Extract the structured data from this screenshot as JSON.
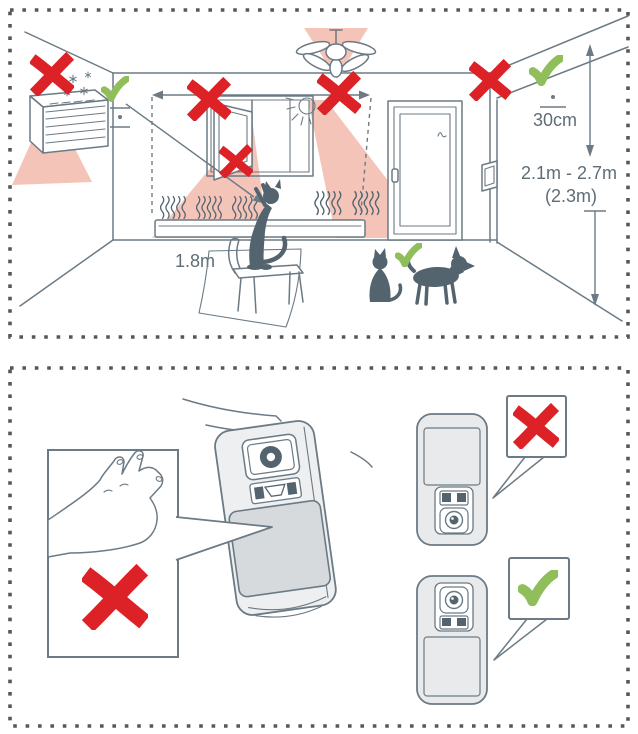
{
  "doc": {
    "type": "sensor-installation-diagram",
    "panel_count": 2
  },
  "room_panel": {
    "labels": {
      "ceiling_clearance": "30cm",
      "mount_height_range": "2.1m - 2.7m",
      "mount_height_recommended": "(2.3m)",
      "pet_reach_height": "1.8m"
    },
    "bad_spots": [
      "above-air-conditioner",
      "beside-window-left",
      "beside-window-under-ceiling-fan",
      "on-open-window",
      "wall-corner-above-door"
    ],
    "good_spots": [
      "left-wall-corner",
      "right-wall-30cm-below-ceiling",
      "pets-kept-below-1.8m"
    ],
    "icons": {
      "error": "x-mark",
      "ok": "check-mark",
      "cold_source": "snowflake",
      "heat_source": "heat-waves",
      "sunlight": "sun"
    }
  },
  "device_panel": {
    "bad": [
      "touching-lens-with-hand",
      "sensor-mounted-upside-down"
    ],
    "good": [
      "sensor-mounted-upright"
    ]
  },
  "colors": {
    "red": "#dc2127",
    "green": "#8fbe5a",
    "pink": "#f4c4b8",
    "line": "#6b7a84",
    "dark": "#54646f",
    "border": "#53585c",
    "label": "#5e6d78",
    "body_fill": "#edeff0",
    "lens_fill": "#d6dadd",
    "panel_fill": "#e8eaec"
  }
}
